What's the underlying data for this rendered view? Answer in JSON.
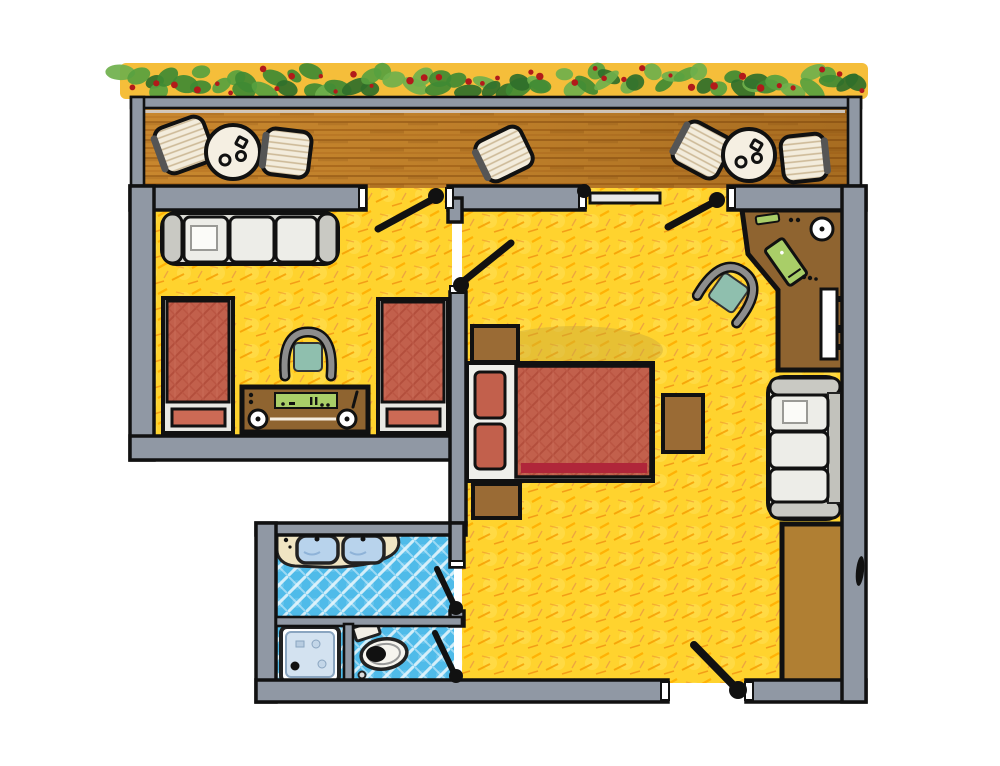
{
  "scene": {
    "kind": "hand-drawn floor plan sketch",
    "description": "Top-down illustrated plan of a hotel suite: balcony terrace with hedge planter at top, main bedroom with double bed, second bedroom with two single beds, bathroom with separate WC, wardrobe and desk along right wall",
    "width_px": 1000,
    "height_px": 766
  },
  "colors": {
    "ink": "#111111",
    "wall": "#9098A4",
    "wallLight": "#D9DCE1",
    "floor": "#FFD32E",
    "floorStroke": "#F08A00",
    "wood": "#C8872E",
    "woodStroke": "#8A4E10",
    "hedgeBand": "#F5BE3A",
    "leaf": "#57A13F",
    "leafLight": "#6FB04C",
    "leafDark": "#2F6F2A",
    "berry": "#B21A1A",
    "tile": "#4FBBE9",
    "tileLine": "#FFFFFF",
    "vanity": "#F0E5C3",
    "sink": "#B8D3EC",
    "showerTray": "#D3E2F0",
    "bedRed": "#C2604C",
    "bedRedDark": "#A8402F",
    "duvetStripe": "#B0263A",
    "pillowRed": "#CC6A55",
    "woodFurniture": "#8F6430",
    "nightstand": "#9A6B35",
    "wardrobe": "#B07F33",
    "sofa": "#DCDCD6",
    "sofaTrim": "#C9C9C3",
    "cushion": "#EDEDE8",
    "seatTeal": "#8FBFAE",
    "displayGreen": "#A9CE68",
    "chairWicker": "#F3ECDC",
    "chairStripe": "#C9B48F",
    "tableTop": "#F5EFE2",
    "white": "#FFFFFF"
  },
  "hedge": {
    "leaf_count": 66,
    "berry_count": 36,
    "label": "hedge planter with red berries"
  },
  "rooms": [
    {
      "id": "balcony",
      "label": "balcony terrace with wood decking"
    },
    {
      "id": "second-bedroom",
      "label": "second bedroom with twin beds and sofa"
    },
    {
      "id": "main-bedroom",
      "label": "main bedroom living area"
    },
    {
      "id": "bathroom",
      "label": "bathroom with double vanity"
    },
    {
      "id": "wc",
      "label": "toilet compartment"
    }
  ],
  "furniture": {
    "balcony": [
      "wicker chair",
      "round table",
      "wicker chair",
      "wicker chair",
      "wicker chair",
      "round table",
      "wicker chair"
    ],
    "second_bedroom": [
      "three-seat sofa",
      "single bed",
      "single bed",
      "small chair",
      "media console with knobs"
    ],
    "main_bedroom": [
      "nightstand",
      "double bed with red duvet",
      "nightstand",
      "side table",
      "armchair",
      "corner desk with lamp and folder",
      "two-seat sofa",
      "wardrobe"
    ],
    "bathroom": [
      "double-sink vanity",
      "shower tray",
      "toilet with cistern"
    ]
  },
  "doors": [
    {
      "id": "balcony-door-left",
      "label": "door to balcony (left)"
    },
    {
      "id": "balcony-door-right",
      "label": "double door to balcony (right)"
    },
    {
      "id": "second-bedroom-door",
      "label": "door between bedrooms"
    },
    {
      "id": "bathroom-door",
      "label": "bathroom door"
    },
    {
      "id": "wc-door",
      "label": "WC door"
    },
    {
      "id": "entrance-door",
      "label": "entrance door (bottom)"
    }
  ]
}
